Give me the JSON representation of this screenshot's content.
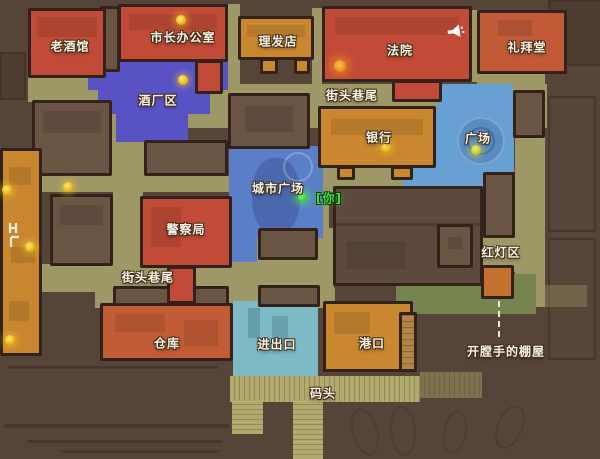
{
  "map": {
    "locations": {
      "old_tavern": {
        "label": "老酒馆"
      },
      "mayor_office": {
        "label": "市长办公室"
      },
      "barber_shop": {
        "label": "理发店"
      },
      "court": {
        "label": "法院"
      },
      "chapel": {
        "label": "礼拜堂"
      },
      "brewery_district": {
        "label": "酒厂区"
      },
      "street_corner_ne": {
        "label": "街头巷尾"
      },
      "bank": {
        "label": "银行"
      },
      "plaza": {
        "label": "广场"
      },
      "city_square": {
        "label": "城市广场"
      },
      "police_station": {
        "label": "警察局"
      },
      "red_light_district": {
        "label": "红灯区"
      },
      "street_corner_w": {
        "label": "街头巷尾"
      },
      "warehouse": {
        "label": "仓库"
      },
      "import_export": {
        "label": "进出口"
      },
      "port": {
        "label": "港口"
      },
      "dock": {
        "label": "码头"
      },
      "ripper_shack": {
        "label": "开膛手的棚屋"
      }
    },
    "player": {
      "label": "[你]"
    },
    "icons": [
      "megaphone-icon",
      "bunk-icon",
      "quest-marker-dot",
      "player-dot",
      "fountain"
    ],
    "quest_marker_count": 9,
    "colors": {
      "background": "#564439",
      "street": "#9e9766",
      "building_neutral": "#6a5444",
      "outline": "#33221c",
      "zone_red": "#c14b37",
      "zone_orange": "#c9872f",
      "zone_red_orange": "#c25c36",
      "zone_purple": "#5952c5",
      "zone_plaza_blue": "#68a0d3",
      "zone_city_blue": "#5b7fc6",
      "zone_teal": "#7cbac6",
      "zone_green": "#76854f",
      "pier_khaki": "#b1a96d",
      "quest_marker": "#eac81c",
      "player_green": "#35d435"
    }
  }
}
